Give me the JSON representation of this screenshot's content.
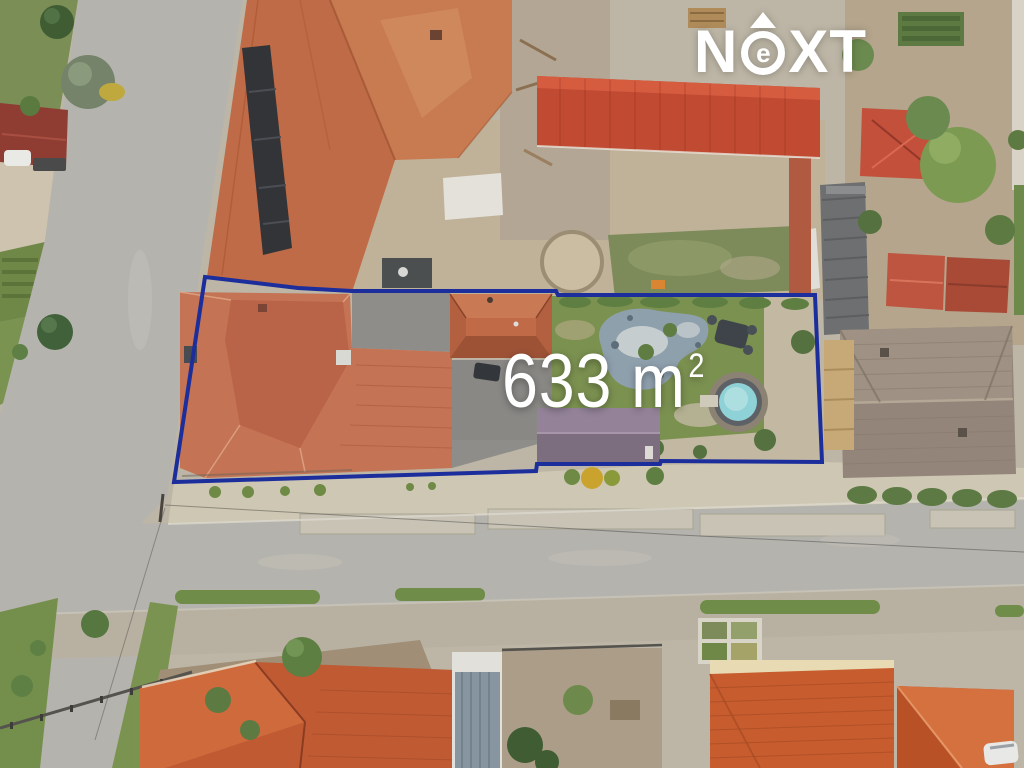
{
  "annotations": {
    "area_label": {
      "value": "633 m",
      "superscript": "2"
    },
    "logo": {
      "part1": "N",
      "e_letter": "e",
      "part2": "XT"
    }
  },
  "colors": {
    "boundary_stroke": "#1c2e9c",
    "label_text": "#ffffff",
    "logo_text": "#ffffff",
    "pool_water": "#8ed1d6",
    "lawn_green": "#7b9150",
    "roof_terracotta": "#c47354",
    "road_gray": "#b5b3ad"
  }
}
